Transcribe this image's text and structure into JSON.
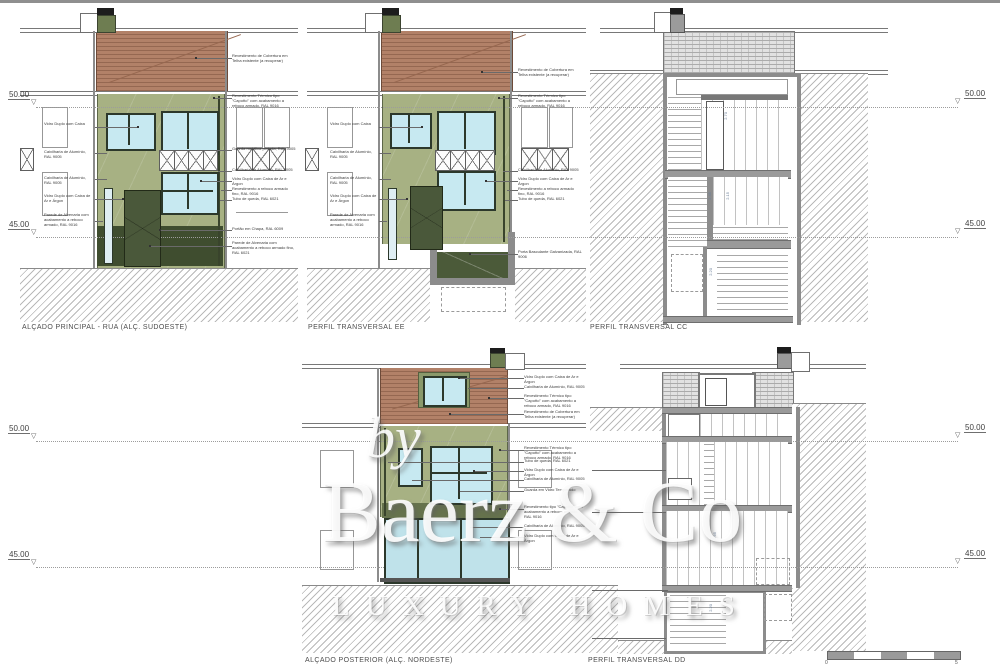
{
  "watermark": {
    "by": "by",
    "brand": "Baerz & Co",
    "tagline": "LUXURY HOMES"
  },
  "markers": {
    "upper": "50.00",
    "lower": "45.00"
  },
  "scalebar": {
    "start": "0",
    "end": "5"
  },
  "drawings": {
    "principal": {
      "label": "ALÇADO PRINCIPAL - RUA (ALÇ. SUDOESTE)",
      "left_annotations": [
        "Vidro Duplo com Caixa",
        "Caixilharia de Alumínio, RAL 9005",
        "Caixilharia de Alumínio, RAL 9005",
        "Vidro Duplo com Caixa de Ar e Árgon",
        "Parede de Alvenaria com acabamento a reboco armado, RAL 9016"
      ],
      "right_annotations": [
        "Revestimento de Cobertura em Telha existente (a recuperar)",
        "Revestimento Térmico tipo \"Capotto\" com acabamento a reboco armado, RAL 9016",
        "Guarda metálica pintada, RAL 9005",
        "Caixilharia de Alumínio, RAL 9005",
        "Vidro Duplo com Caixa de Ar e Árgon",
        "Revestimento a reboco armado fino, RAL 9016",
        "Tubo de queda, RAL 6021",
        "Portão em Chapa, RAL 6009",
        "Parede de Alvenaria com acabamento a reboco armado fino, RAL 6021"
      ]
    },
    "ee": {
      "label": "PERFIL TRANSVERSAL EE",
      "left_annotations": [
        "Vidro Duplo com Caixa",
        "Caixilharia de Alumínio, RAL 9005",
        "Caixilharia de Alumínio, RAL 9005",
        "Vidro Duplo com Caixa de Ar e Árgon",
        "Parede de Alvenaria com acabamento a reboco armado, RAL 9016"
      ],
      "right_annotations": [
        "Revestimento de Cobertura em Telha existente (a recuperar)",
        "Revestimento Térmico tipo \"Capotto\" com acabamento a reboco armado, RAL 9016",
        "Caixilharia de Alumínio, RAL 9005",
        "Vidro Duplo com Caixa de Ar e Árgon",
        "Revestimento a reboco armado fino, RAL 9016",
        "Tubo de queda, RAL 6021",
        "Porta Basculante Galvanizada, RAL 9006"
      ]
    },
    "cc": {
      "label": "PERFIL TRANSVERSAL CC",
      "dims": [
        "2.70",
        "2.45",
        "2.15",
        "2.20"
      ]
    },
    "posterior": {
      "label": "ALÇADO POSTERIOR (ALÇ. NORDESTE)",
      "top_annotations": [
        "Vidro Duplo com Caixa de Ar e Árgon",
        "Caixilharia de Alumínio, RAL 9005",
        "Revestimento Térmico tipo \"Capotto\" com acabamento a reboco armado, RAL 9016",
        "Revestimento de Cobertura em Telha existente (a recuperar)"
      ],
      "mid_annotations": [
        "Revestimento Térmico tipo \"Capotto\" com acabamento a reboco armado, RAL 9016",
        "Tubo de queda, RAL 6021",
        "Vidro Duplo com Caixa de Ar e Árgon",
        "Caixilharia de Alumínio, RAL 9005",
        "Guarda em Vidro Temperado",
        "Revestimento tipo \"Capotto\" com acabamento a reboco armado, RAL 9016",
        "Caixilharia de Alumínio, RAL 9005",
        "Vidro Duplo com Caixa de Ar e Árgon"
      ]
    },
    "dd": {
      "label": "PERFIL TRANSVERSAL DD",
      "dims": [
        "2.65",
        "2.20"
      ]
    }
  }
}
